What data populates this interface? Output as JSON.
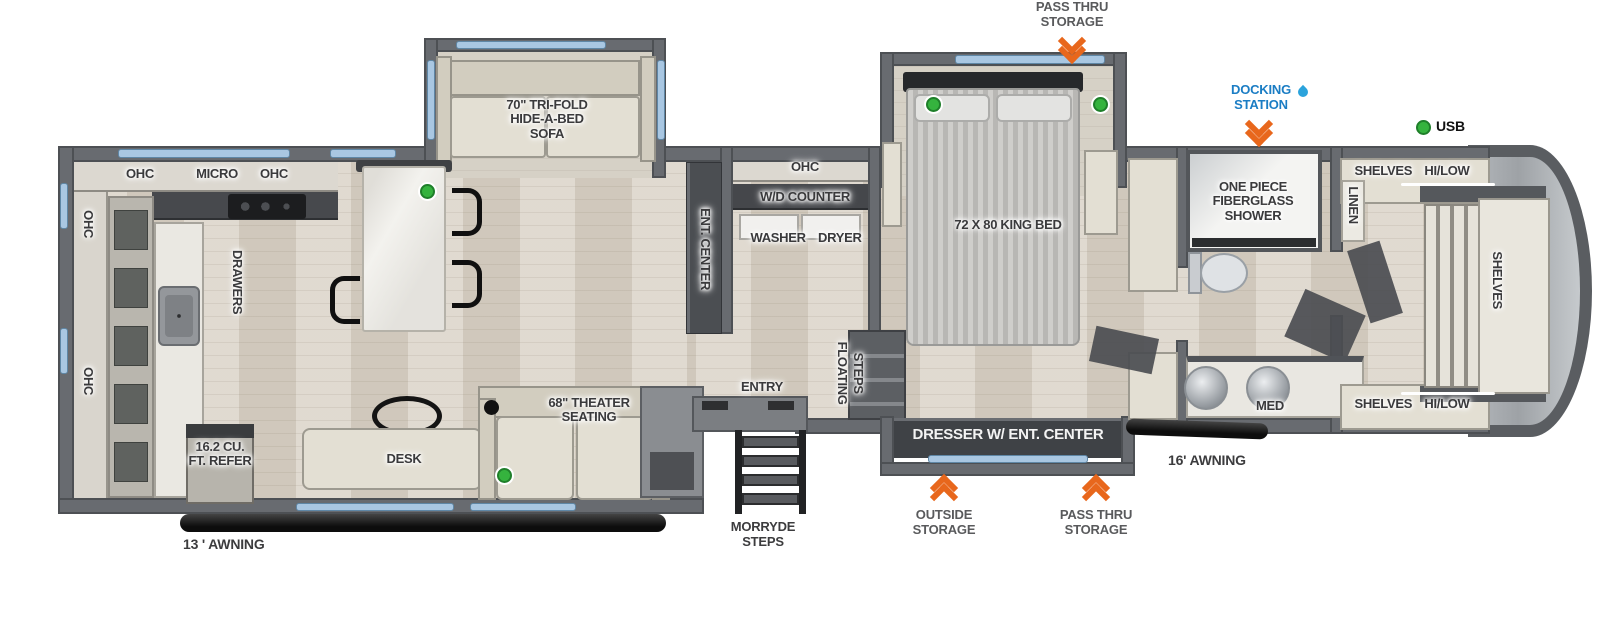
{
  "fp": {
    "pass_thru_top": "PASS THRU STORAGE",
    "docking_station": "DOCKING STATION",
    "usb": "USB",
    "sofa": "70\" TRI-FOLD HIDE-A-BED SOFA",
    "ohc_a": "OHC",
    "micro": "MICRO",
    "ohc_b": "OHC",
    "ohc_left_upper": "OHC",
    "ohc_left_lower": "OHC",
    "drawers": "DRAWERS",
    "ent_center": "ENT. CENTER",
    "ohc_wd": "OHC",
    "wd_counter": "W/D COUNTER",
    "washer_dryer": "WASHER DRYER",
    "king_bed": "72 X 80 KING BED",
    "shower": "ONE PIECE FIBERGLASS SHOWER",
    "linen": "LINEN",
    "shelves_hilow_top": "SHELVES HI/LOW",
    "shelves_hilow_bottom": "SHELVES HI/LOW",
    "shelves_front": "SHELVES",
    "med": "MED",
    "floating": "FLOATING",
    "steps": "STEPS",
    "entry": "ENTRY",
    "theater": "68\" THEATER SEATING",
    "desk": "DESK",
    "refer": "16.2 CU. FT. REFER",
    "awning_13": "13 ' AWNING",
    "morryde": "MORRYDE STEPS",
    "dresser": "DRESSER W/ ENT. CENTER",
    "awning_16": "16' AWNING",
    "outside_storage": "OUTSIDE STORAGE",
    "pass_thru_bottom": "PASS THRU STORAGE"
  },
  "colors": {
    "accent_orange": "#e8671c",
    "docking_blue": "#1b7dc4",
    "usb_green": "#35b33e",
    "window_blue": "#a9c7e2",
    "wall_gray": "#686b70"
  }
}
